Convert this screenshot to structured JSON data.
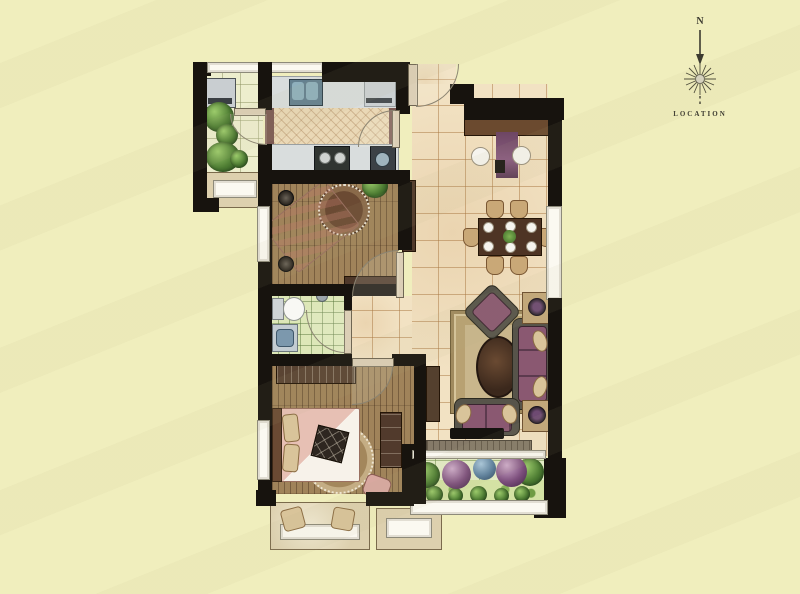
{
  "compass": {
    "north_label": "N",
    "location_label": "LOCATION"
  },
  "colors": {
    "background": "#f0eebd",
    "wall": "#17130e",
    "tile_floor": "#f2e2c3",
    "wood_floor": "#a0835a",
    "bath_floor": "#dde7b8",
    "balcony_floor": "#e4edc6",
    "counter": "#d9dddd",
    "furniture_brown": "#4e382a",
    "sofa_purple": "#8a5871",
    "rug_tan": "#c9b68c",
    "bed_pink": "#e7c0b4",
    "plant_green": "#4e7d33",
    "sphere_purple": "#7d4f7d",
    "sphere_blue": "#5b7f9e",
    "window_fill": "#fbf9f1",
    "bay_fill": "#ddd0ae",
    "compass_ink": "#3c3a30"
  },
  "regions": [
    "service-balcony",
    "kitchen",
    "entry",
    "dining-area",
    "living-room",
    "bedroom-upper",
    "bathroom",
    "bedroom-lower",
    "hallway",
    "south-balcony",
    "bay-window-seat",
    "window-ledge"
  ]
}
